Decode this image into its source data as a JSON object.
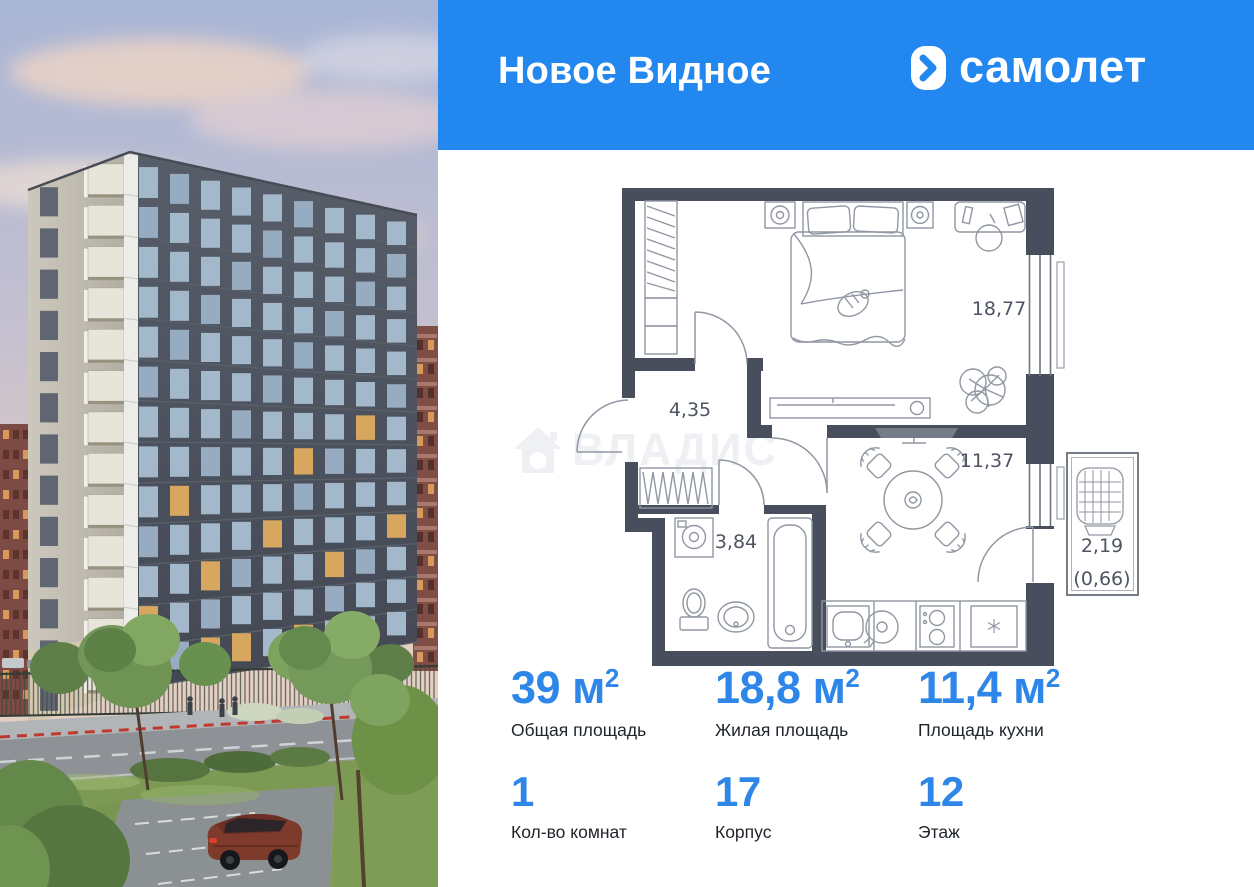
{
  "header": {
    "project_title": "Новое Видное",
    "background_color": "#2387F0",
    "brand": {
      "logo_text": "самолет",
      "icon": "samolet-arrow-icon",
      "icon_color": "#2387F0"
    }
  },
  "floor_plan": {
    "watermark": {
      "text": "ВЛАДИС",
      "icon": "house-icon"
    },
    "wall_color": "#484E5C",
    "label_color": "#4D5561",
    "labels": {
      "bedroom": "18,77",
      "hallway": "4,35",
      "bathroom": "3,84",
      "kitchen": "11,37",
      "balcony": "2,19",
      "balcony_reduced": "(0,66)"
    }
  },
  "stats": {
    "accent_color": "#2E87E8",
    "primary": [
      {
        "value": "39",
        "unit": "м",
        "sup": "2",
        "label": "Общая площадь"
      },
      {
        "value": "18,8",
        "unit": "м",
        "sup": "2",
        "label": "Жилая площадь"
      },
      {
        "value": "11,4",
        "unit": "м",
        "sup": "2",
        "label": "Площадь кухни"
      }
    ],
    "secondary": [
      {
        "value": "1",
        "label": "Кол-во комнат"
      },
      {
        "value": "17",
        "label": "Корпус"
      },
      {
        "value": "12",
        "label": "Этаж"
      }
    ]
  }
}
